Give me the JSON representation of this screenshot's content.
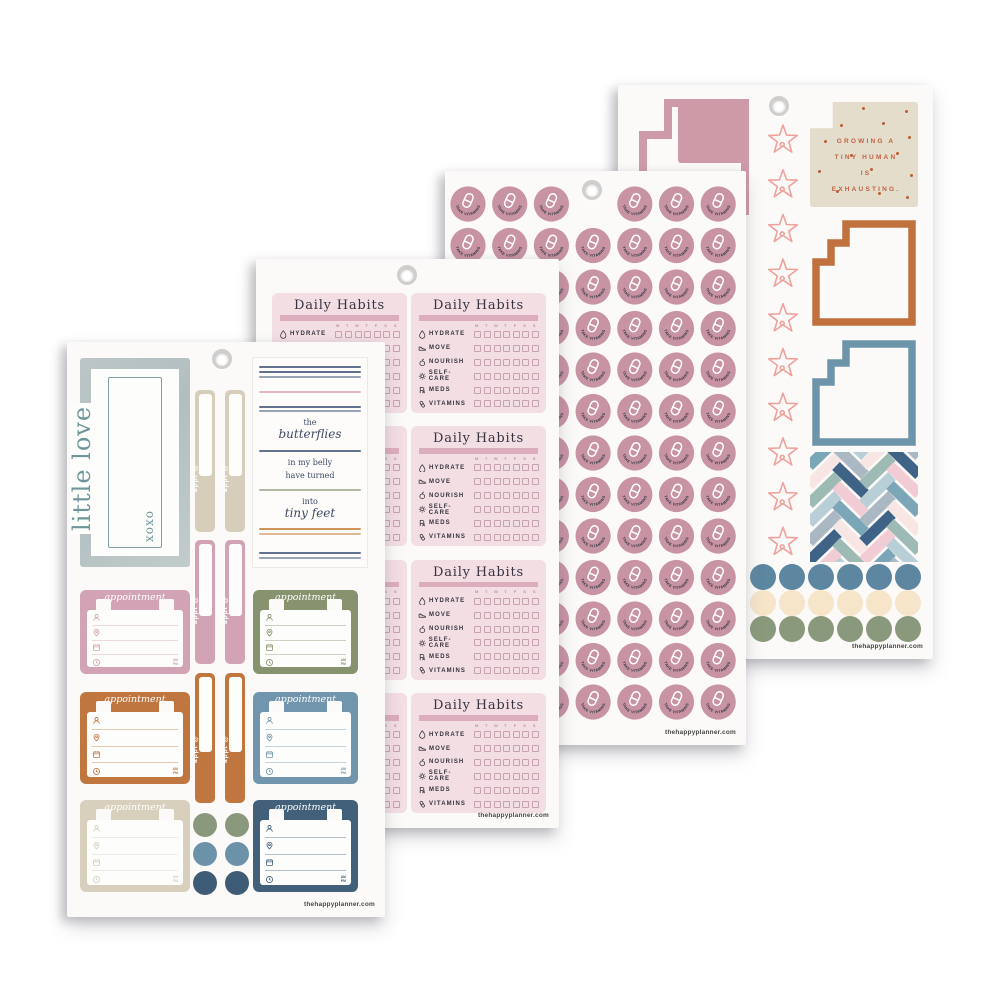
{
  "brand": "thehappyplanner.com",
  "colors": {
    "paper": "#fbfaf8",
    "sheet1": {
      "frame_bg": "#b6c1c2",
      "frame_text": "#6d9699",
      "tab_colors": [
        "#d6cdbb",
        "#d2a3b5",
        "#c0773f"
      ],
      "appointment_colors": [
        "#d2a3b5",
        "#87926f",
        "#c0773f",
        "#7195ac",
        "#d8d0bc",
        "#42607a"
      ],
      "dot_colors": [
        "#8a987c",
        "#8a987c",
        "#6c92a9",
        "#6c92a9",
        "#3e5c76",
        "#3e5c76"
      ],
      "quote_navy": "#46597a",
      "quote_pink": "#e0a9b6",
      "quote_sage": "#a3ad92",
      "quote_orange": "#c8803f"
    },
    "sheet2": {
      "box_bg": "#f3dee4",
      "bar": "#dcadbd",
      "checkbox_border": "#c7a2b0"
    },
    "sheet3": {
      "circle": "#c893a3",
      "pill": "#ffffff",
      "label_text": "#2f3540"
    },
    "sheet4": {
      "star": "#efa29c",
      "quote_bg": "#e4ddcc",
      "quote_text": "#bf6241",
      "stair": "#cf9aa8",
      "square_colors": [
        "#c0713d",
        "#6e94a9"
      ],
      "sliver_colors": [
        "#cf9aa8",
        "#3f5d77",
        "#c0773f",
        "#c89f6d"
      ],
      "dot_row_colors": [
        "#5d86a0",
        "#f6e5c9",
        "#8a997b"
      ],
      "herringbone": [
        "#3e6386",
        "#f2ccd4",
        "#7ba6b8",
        "#f7e6e4",
        "#9dbbb4",
        "#b9cfd8",
        "#a9b8c3"
      ]
    }
  },
  "sheet1": {
    "frame_sticker": {
      "main_text": "little love",
      "side_text": "xoxo"
    },
    "tab_label": "appt @",
    "tab_pairs": 3,
    "quote_sticker": {
      "word1": "the",
      "word2": "butterflies",
      "line3": "in my belly",
      "line4": "have turned",
      "word5": "into",
      "word6": "tiny feet"
    },
    "appointment_label": "appointment",
    "am_label": "AM",
    "pm_label": "PM",
    "appointment_count": 6,
    "dot_count": 6
  },
  "sheet2": {
    "box_title": "Daily Habits",
    "day_letters": [
      "M",
      "T",
      "W",
      "T",
      "F",
      "S",
      "S"
    ],
    "habits": [
      {
        "icon": "water-drop-icon",
        "label": "HYDRATE"
      },
      {
        "icon": "shoe-icon",
        "label": "MOVE"
      },
      {
        "icon": "apple-icon",
        "label": "NOURISH"
      },
      {
        "icon": "sun-icon",
        "label": "SELF-CARE"
      },
      {
        "icon": "rx-icon",
        "label": "MEDS"
      },
      {
        "icon": "pill-icon",
        "label": "VITAMINS"
      }
    ],
    "checkboxes_per_habit": 7,
    "box_rows": 4,
    "box_cols": 2
  },
  "sheet3": {
    "circle_label": "TAKE VITAMINS",
    "grid_cols": 7,
    "grid_rows": 13,
    "hole_skip": {
      "row": 0,
      "col": 3
    }
  },
  "sheet4": {
    "quote_sticker": {
      "line1": "GROWING A",
      "line2": "TINY HUMAN",
      "line3": "IS",
      "line4": "EXHAUSTING."
    },
    "star_count": 10,
    "outline_square_count": 2,
    "dots_per_row": 6,
    "dot_rows": 3
  }
}
